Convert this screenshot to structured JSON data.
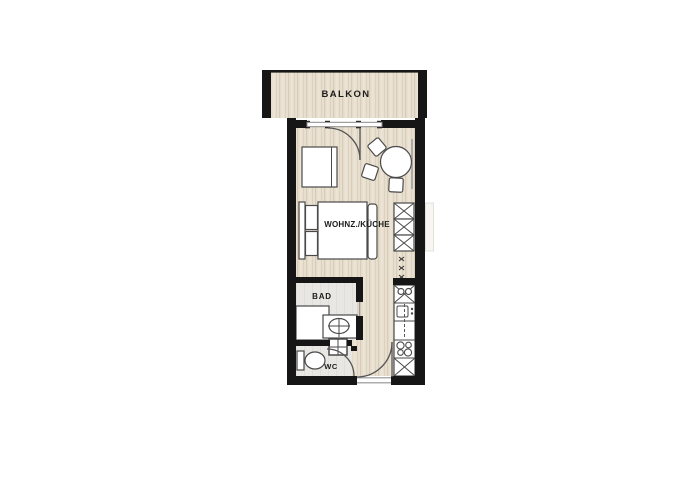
{
  "type": "apartment-floor-plan",
  "rooms": {
    "balcony": {
      "label": "BALKON"
    },
    "living_kitchen": {
      "label": "WOHNZ./KÜCHE"
    },
    "bathroom": {
      "label": "BAD"
    },
    "wc": {
      "label": "WC"
    }
  },
  "colors": {
    "wall": "#161616",
    "wood_floor_base": "#e8dfcf",
    "wood_floor_stripe": "#d8ccb8",
    "tile_floor": "#e8e7e4",
    "furniture_outline": "#4a4a4a",
    "background": "#ffffff"
  },
  "furniture_icons": [
    "double-bed-icon",
    "desk-icon",
    "dining-table-icon",
    "chair-icon",
    "wardrobe-icon",
    "coat-hooks-icon",
    "kitchen-sink-icon",
    "oven-icon",
    "cooktop-icon",
    "base-cabinet-icon",
    "shower-icon",
    "vanity-sink-icon",
    "hand-basin-icon",
    "toilet-icon",
    "radiator-icon",
    "door-swing-icon",
    "window-icon"
  ]
}
